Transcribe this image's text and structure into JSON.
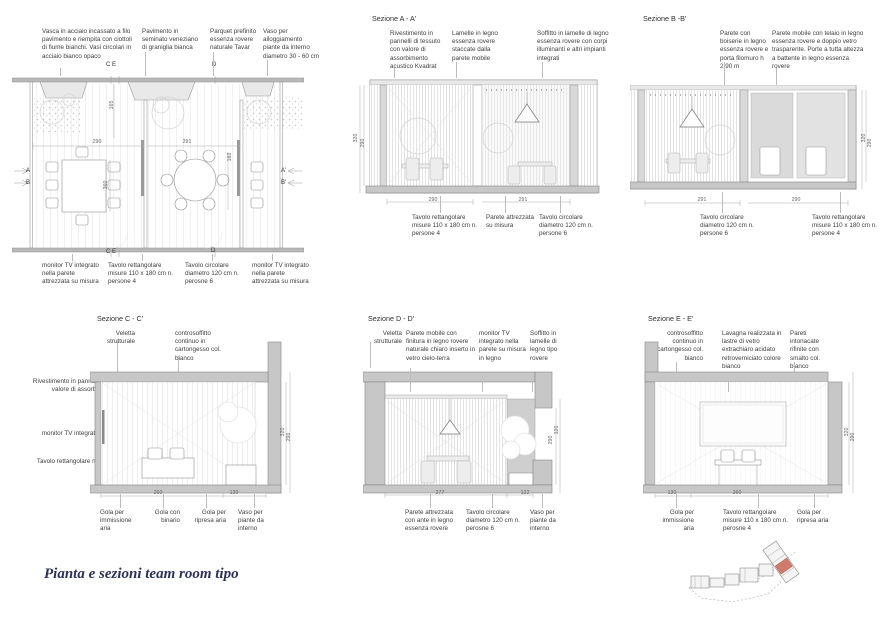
{
  "footer": {
    "title": "Pianta e sezioni team room tipo"
  },
  "colors": {
    "title_navy": "#2c3157",
    "wall_gray": "#c7c7c7",
    "keyplan_red": "#cf7b6d"
  },
  "plan": {
    "top_notes": [
      "Vasca in acciaio incassato a filo pavimento e riempita con ciottoli di fiume bianchi. Vasi circolari in acciaio bianco opaco",
      "Pavimento in seminato veneziano di graniglia bianca",
      "Parquet prefinito essenza rovere naturale Tavar",
      "Vaso per alloggiamento piante da interno diametro 30 - 60 cm"
    ],
    "bottom_notes": [
      "monitor TV integrato nella parete attrezzata su misura",
      "Tavolo rettangolare misure 110 x 180 cm n. persone 4",
      "Tavolo circolare diametro 120 cm n. perosne 6",
      "monitor TV integrato nella parete attrezzata su misura"
    ],
    "markers": {
      "a": "A",
      "b": "B",
      "a1": "A'",
      "b1": "B'",
      "ce_top": "C E",
      "d_top": "D",
      "ce_bottom": "C E",
      "d_bottom": "D"
    },
    "dims": {
      "w1": "290",
      "w2": "291",
      "v1": "165",
      "v2": "360",
      "v3": "160"
    }
  },
  "section_aa": {
    "title": "Sezione A - A'",
    "top_notes": [
      "Rivestimento in pannelli di tessuto con valore di assorbimento acustico Kvadrat",
      "Lamelle in legno essenza rovere staccate dalla parete mobile",
      "Soffitto in lamelle di legno essenza rovere con corpi illuminanti e altri impianti integrati"
    ],
    "bottom_notes": [
      "Tavolo rettangolare misure 110 x 180 cm n. persone 4",
      "Parete attrezzata su misura",
      "Tavolo circolare diametro 120 cm n. persone 6"
    ],
    "dims": {
      "w1": "290",
      "w2": "291",
      "h1": "320",
      "h2": "290"
    }
  },
  "section_bb": {
    "title": "Sezione B -B'",
    "top_notes": [
      "Parete con boiserie in legno essenza rovere e porta filomuro h 2.90 m",
      "Parete mobile con telaio in legno essenza rovere e doppio vetro trasparente. Porte a tutta altezza a battente in legno essenza rovere"
    ],
    "bottom_notes": [
      "Tavolo circolare diametro 120 cm n. persone 6",
      "Tavolo rettangolare misure 110 x 180 cm n. persone 4"
    ],
    "dims": {
      "w1": "291",
      "w2": "290",
      "h1": "320",
      "h2": "290"
    }
  },
  "section_cc": {
    "title": "Sezione C - C'",
    "top_notes": [
      "Veletta strutturale",
      "controsoffitto continuo in cartongesso col. bianco"
    ],
    "left_notes": [
      "Rivestimento in pannelli di tessuto con valore di assorbimento acustico Kvadrat",
      "monitor TV integrato nella parete di tessuto",
      "Tavolo rettangolare misure 110 x 180 cm n. perosne 4"
    ],
    "bottom_notes": [
      "Gola per immissione aria",
      "Gola con binario",
      "Gola per ripresa aria",
      "Vaso per piante da interno"
    ],
    "dims": {
      "w1": "260",
      "w2": "130",
      "h1": "320",
      "h2": "290"
    }
  },
  "section_dd": {
    "title": "Sezione D - D'",
    "top_notes": [
      "Veletta strutturale",
      "Parete mobile con finitura in legno rovere naturale chiaro inserto in vetro cielo-terra",
      "monitor TV integrato nella parete su misura in legno",
      "Soffitto in lamelle di legno tipo rovere"
    ],
    "bottom_notes": [
      "Parete attrezzata con ante in legno essenza rovere",
      "Tavolo circolare diametro 120 cm n. perosne 6",
      "Vaso per piante da interno"
    ],
    "dims": {
      "w1": "277",
      "w2": "122",
      "h1": "320",
      "h2": "290"
    }
  },
  "section_ee": {
    "title": "Sezione E - E'",
    "top_notes": [
      "controsoffitto continuo in cartongesso col. bianco",
      "Lavagna realizzata in lastre di vetro extrachiaro acidato retroverniciato colore bianco",
      "Pareti intonacate rifinite con smalto col. bianco"
    ],
    "bottom_notes": [
      "Gola per immissione aria",
      "Tavolo rettangolare misure 110 x 180 cm n. perosne 4",
      "Gola per ripresa aria"
    ],
    "dims": {
      "w1": "130",
      "w2": "260",
      "h1": "320",
      "h2": "290"
    }
  }
}
